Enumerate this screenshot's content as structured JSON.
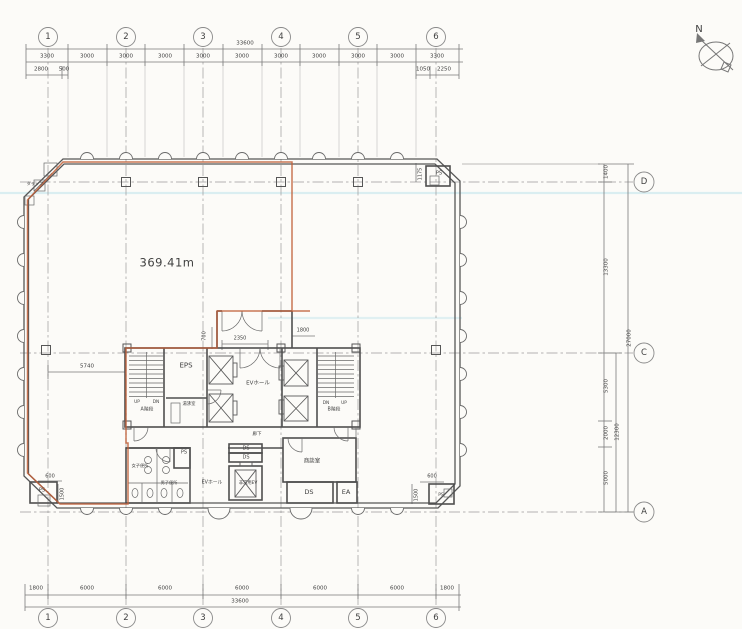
{
  "colors": {
    "tenant_boundary": "#c05f38",
    "scan_artifact": "#daeef1",
    "linework": "#5a5a5a",
    "paper": "#fcfbf8"
  },
  "labels": [
    {
      "n": "grid-bubble-top-1",
      "t": "1",
      "x": 48,
      "y": 37,
      "s": 8.5
    },
    {
      "n": "grid-bubble-top-2",
      "t": "2",
      "x": 126,
      "y": 37,
      "s": 8.5
    },
    {
      "n": "grid-bubble-top-3",
      "t": "3",
      "x": 203,
      "y": 37,
      "s": 8.5
    },
    {
      "n": "grid-bubble-top-4",
      "t": "4",
      "x": 281,
      "y": 37,
      "s": 8.5
    },
    {
      "n": "grid-bubble-top-5",
      "t": "5",
      "x": 358,
      "y": 37,
      "s": 8.5
    },
    {
      "n": "grid-bubble-top-6",
      "t": "6",
      "x": 436,
      "y": 37,
      "s": 8.5
    },
    {
      "n": "dim-top-total",
      "t": "33600",
      "x": 245,
      "y": 44,
      "s": 5.5
    },
    {
      "n": "dim-top-seg",
      "t": "3300",
      "x": 47,
      "y": 57,
      "s": 5.5
    },
    {
      "n": "dim-top-seg",
      "t": "3000",
      "x": 87,
      "y": 57,
      "s": 5.5
    },
    {
      "n": "dim-top-seg",
      "t": "3000",
      "x": 126,
      "y": 57,
      "s": 5.5
    },
    {
      "n": "dim-top-seg",
      "t": "3000",
      "x": 165,
      "y": 57,
      "s": 5.5
    },
    {
      "n": "dim-top-seg",
      "t": "3000",
      "x": 203,
      "y": 57,
      "s": 5.5
    },
    {
      "n": "dim-top-seg",
      "t": "3000",
      "x": 242,
      "y": 57,
      "s": 5.5
    },
    {
      "n": "dim-top-seg",
      "t": "3000",
      "x": 281,
      "y": 57,
      "s": 5.5
    },
    {
      "n": "dim-top-seg",
      "t": "3000",
      "x": 319,
      "y": 57,
      "s": 5.5
    },
    {
      "n": "dim-top-seg",
      "t": "3000",
      "x": 358,
      "y": 57,
      "s": 5.5
    },
    {
      "n": "dim-top-seg",
      "t": "3000",
      "x": 397,
      "y": 57,
      "s": 5.5
    },
    {
      "n": "dim-top-seg",
      "t": "3300",
      "x": 437,
      "y": 57,
      "s": 5.5
    },
    {
      "n": "dim-top-sub",
      "t": "2800",
      "x": 41,
      "y": 70,
      "s": 5.5
    },
    {
      "n": "dim-top-sub",
      "t": "500",
      "x": 64,
      "y": 70,
      "s": 5.5
    },
    {
      "n": "dim-top-sub",
      "t": "1050",
      "x": 423,
      "y": 70,
      "s": 5.5
    },
    {
      "n": "dim-top-sub",
      "t": "2250",
      "x": 444,
      "y": 70,
      "s": 5.5
    },
    {
      "n": "dim-bottom-seg",
      "t": "1800",
      "x": 36,
      "y": 589,
      "s": 5.5
    },
    {
      "n": "dim-bottom-seg",
      "t": "6000",
      "x": 87,
      "y": 589,
      "s": 5.5
    },
    {
      "n": "dim-bottom-seg",
      "t": "6000",
      "x": 165,
      "y": 589,
      "s": 5.5
    },
    {
      "n": "dim-bottom-seg",
      "t": "6000",
      "x": 242,
      "y": 589,
      "s": 5.5
    },
    {
      "n": "dim-bottom-seg",
      "t": "6000",
      "x": 320,
      "y": 589,
      "s": 5.5
    },
    {
      "n": "dim-bottom-seg",
      "t": "6000",
      "x": 397,
      "y": 589,
      "s": 5.5
    },
    {
      "n": "dim-bottom-seg",
      "t": "1800",
      "x": 447,
      "y": 589,
      "s": 5.5
    },
    {
      "n": "dim-bottom-total",
      "t": "33600",
      "x": 240,
      "y": 602,
      "s": 5.5
    },
    {
      "n": "grid-bubble-bottom-1",
      "t": "1",
      "x": 48,
      "y": 618,
      "s": 8.5
    },
    {
      "n": "grid-bubble-bottom-2",
      "t": "2",
      "x": 126,
      "y": 618,
      "s": 8.5
    },
    {
      "n": "grid-bubble-bottom-3",
      "t": "3",
      "x": 203,
      "y": 618,
      "s": 8.5
    },
    {
      "n": "grid-bubble-bottom-4",
      "t": "4",
      "x": 281,
      "y": 618,
      "s": 8.5
    },
    {
      "n": "grid-bubble-bottom-5",
      "t": "5",
      "x": 358,
      "y": 618,
      "s": 8.5
    },
    {
      "n": "grid-bubble-bottom-6",
      "t": "6",
      "x": 436,
      "y": 618,
      "s": 8.5
    },
    {
      "n": "grid-bubble-right-d",
      "t": "D",
      "x": 644,
      "y": 182,
      "s": 8.5
    },
    {
      "n": "grid-bubble-right-c",
      "t": "C",
      "x": 644,
      "y": 353,
      "s": 8.5
    },
    {
      "n": "grid-bubble-right-a",
      "t": "A",
      "x": 644,
      "y": 512,
      "s": 8.5
    },
    {
      "n": "dim-right",
      "t": "1400",
      "x": 607,
      "y": 172,
      "s": 5.5,
      "r": 1
    },
    {
      "n": "dim-right",
      "t": "13300",
      "x": 607,
      "y": 267,
      "s": 5.5,
      "r": 1
    },
    {
      "n": "dim-right",
      "t": "27000",
      "x": 630,
      "y": 338,
      "s": 5.5,
      "r": 1
    },
    {
      "n": "dim-right",
      "t": "5300",
      "x": 607,
      "y": 386,
      "s": 5.5,
      "r": 1
    },
    {
      "n": "dim-right",
      "t": "2000",
      "x": 607,
      "y": 433,
      "s": 5.5,
      "r": 1
    },
    {
      "n": "dim-right",
      "t": "5000",
      "x": 607,
      "y": 478,
      "s": 5.5,
      "r": 1
    },
    {
      "n": "dim-right",
      "t": "12300",
      "x": 618,
      "y": 432,
      "s": 5.5,
      "r": 1
    },
    {
      "n": "area-label",
      "t": "369.41m",
      "x": 167,
      "y": 263,
      "s": 11.5
    },
    {
      "n": "north-label",
      "t": "N",
      "x": 699,
      "y": 30,
      "s": 10
    },
    {
      "n": "dim-interior",
      "t": "5740",
      "x": 87,
      "y": 367,
      "s": 5.5
    },
    {
      "n": "dim-interior",
      "t": "600",
      "x": 50,
      "y": 477,
      "s": 5
    },
    {
      "n": "dim-interior",
      "t": "2350",
      "x": 240,
      "y": 339,
      "s": 5
    },
    {
      "n": "dim-interior",
      "t": "1800",
      "x": 303,
      "y": 331,
      "s": 5
    },
    {
      "n": "dim-interior",
      "t": "700",
      "x": 205,
      "y": 336,
      "s": 5,
      "r": 1
    },
    {
      "n": "dim-interior",
      "t": "1175",
      "x": 421,
      "y": 174,
      "s": 5,
      "r": 1
    },
    {
      "n": "dim-interior",
      "t": "600",
      "x": 432,
      "y": 477,
      "s": 5
    },
    {
      "n": "dim-interior",
      "t": "1500",
      "x": 417,
      "y": 495,
      "s": 5,
      "r": 1
    },
    {
      "n": "dim-interior",
      "t": "1500",
      "x": 63,
      "y": 494,
      "s": 5,
      "r": 1
    },
    {
      "n": "room-eps",
      "t": "EPS",
      "x": 186,
      "y": 366,
      "s": 7
    },
    {
      "n": "room-yuwakashi",
      "t": "湯沸室",
      "x": 189,
      "y": 405,
      "s": 4.3
    },
    {
      "n": "room-ev-hall",
      "t": "EVホール",
      "x": 258,
      "y": 384,
      "s": 5.5
    },
    {
      "n": "stair-a-up",
      "t": "UP",
      "x": 137,
      "y": 403,
      "s": 4.3
    },
    {
      "n": "stair-a-dn",
      "t": "DN",
      "x": 156,
      "y": 403,
      "s": 4.3
    },
    {
      "n": "room-stair-a",
      "t": "A階段",
      "x": 147,
      "y": 411,
      "s": 4.8
    },
    {
      "n": "stair-b-dn",
      "t": "DN",
      "x": 326,
      "y": 404,
      "s": 4.3
    },
    {
      "n": "stair-b-up",
      "t": "UP",
      "x": 344,
      "y": 404,
      "s": 4.3
    },
    {
      "n": "room-stair-b",
      "t": "B階段",
      "x": 334,
      "y": 411,
      "s": 4.8
    },
    {
      "n": "room-corridor",
      "t": "廊下",
      "x": 257,
      "y": 435,
      "s": 4.5
    },
    {
      "n": "room-ds",
      "t": "DS",
      "x": 246,
      "y": 449,
      "s": 5
    },
    {
      "n": "room-ds",
      "t": "DS",
      "x": 246,
      "y": 458,
      "s": 5
    },
    {
      "n": "room-ev-hall-lower",
      "t": "EVホール",
      "x": 212,
      "y": 484,
      "s": 4.8
    },
    {
      "n": "room-emergency-ev",
      "t": "非常用EV",
      "x": 248,
      "y": 484,
      "s": 4.3
    },
    {
      "n": "room-meeting",
      "t": "商談室",
      "x": 312,
      "y": 462,
      "s": 5.5
    },
    {
      "n": "room-ds",
      "t": "DS",
      "x": 309,
      "y": 492,
      "s": 6.5
    },
    {
      "n": "room-ea",
      "t": "EA",
      "x": 346,
      "y": 492,
      "s": 6.5
    },
    {
      "n": "room-ps",
      "t": "PS",
      "x": 184,
      "y": 453,
      "s": 5
    },
    {
      "n": "room-ps",
      "t": "PS",
      "x": 42,
      "y": 491,
      "s": 5
    },
    {
      "n": "room-ps",
      "t": "PS",
      "x": 441,
      "y": 496,
      "s": 4.5
    },
    {
      "n": "room-ps",
      "t": "PS",
      "x": 439,
      "y": 174,
      "s": 5
    },
    {
      "n": "room-tarappu",
      "t": "タラップ",
      "x": 35,
      "y": 184,
      "s": 4.2
    },
    {
      "n": "room-toilet-women",
      "t": "女子便所",
      "x": 140,
      "y": 466,
      "s": 4.2
    },
    {
      "n": "room-toilet-men",
      "t": "男子便所",
      "x": 169,
      "y": 483,
      "s": 4.2
    }
  ]
}
